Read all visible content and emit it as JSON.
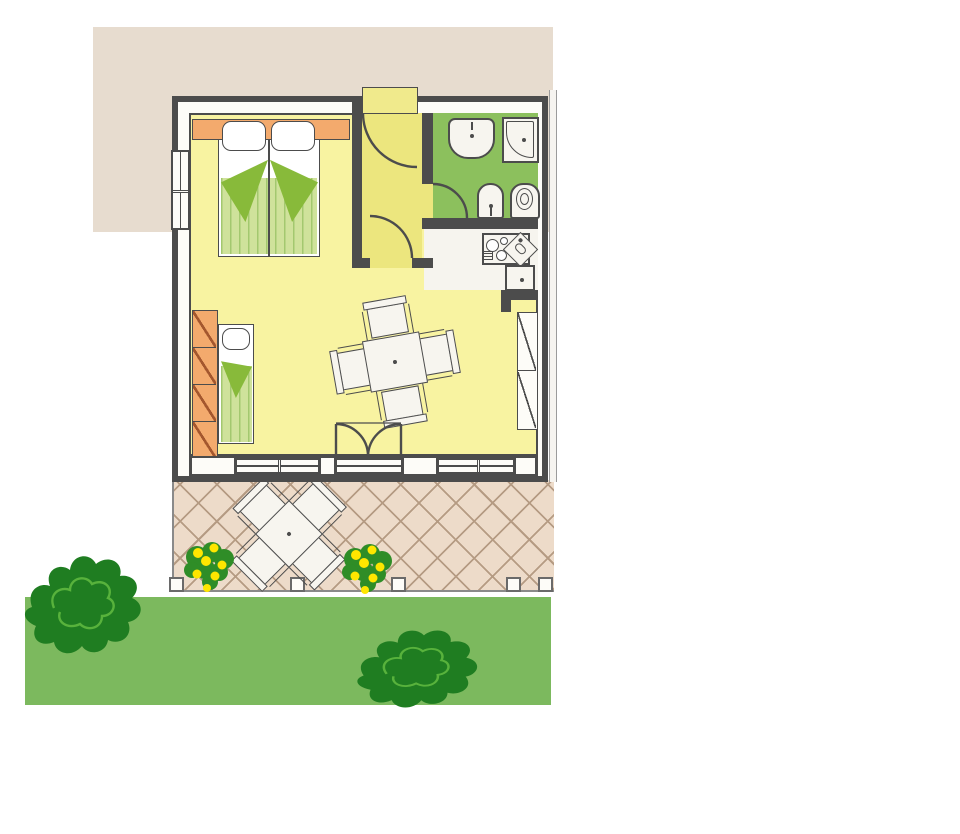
{
  "scene": {
    "kind": "holiday-bungalow floor plan illustration",
    "text_visible": "none",
    "rooms": [
      {
        "name": "sleeping-area",
        "floor_color_key": "floor",
        "furniture": [
          "double-bed with 2 pillows and green striped blanket",
          "orange headboard shelf",
          "single-bed with pillow and green striped blanket",
          "orange wardrobe with 4 compartments"
        ]
      },
      {
        "name": "living-area",
        "floor_color_key": "floor",
        "furniture": [
          "square dining table",
          "4 dining chairs",
          "built-in closet with 2 compartments"
        ]
      },
      {
        "name": "hallway",
        "floor_color_key": "hallway",
        "doors": [
          "entrance-door",
          "door-to-living-area",
          "door-to-bathroom"
        ]
      },
      {
        "name": "bathroom",
        "floor_color_key": "bath",
        "fixtures": [
          "washbasin",
          "shower",
          "bidet",
          "toilet"
        ]
      },
      {
        "name": "kitchenette",
        "floor_color_key": "kitchen",
        "fixtures": [
          "stove with 4 burners",
          "corner sink unit",
          "base cabinet"
        ]
      }
    ],
    "windows": {
      "left_wall": 1,
      "garden_wall": 2
    },
    "doors_total": 4,
    "outdoor": {
      "patio": {
        "paving": "diamond cross-hatch",
        "furniture": [
          "square patio table",
          "4 patio chairs"
        ],
        "posts": 5,
        "flowering_plants": 2
      },
      "garden": {
        "lawn_strip": 1,
        "bushes": 2
      },
      "backdrop_panel": "beige rectangle top-left"
    }
  },
  "colors": {
    "page_bg": "#ffffff",
    "backdrop": "#e7dccf",
    "wall": "#4c4c4c",
    "floor": "#f8f3a1",
    "hallway": "#ece67e",
    "entrance": "#f0ea8c",
    "bath": "#8cc05d",
    "kitchen": "#f6f4ee",
    "fixture": "#f7f5ef",
    "bed_light": "#cfe29b",
    "bed_stripe": "#a3c86f",
    "bed_fold": "#88ba3a",
    "orange": "#f3aa6d",
    "orange_diag": "#a4572e",
    "patio": "#eddbc9",
    "patio_line": "#b59b83",
    "lawn": "#7cb95e",
    "bush": "#1f7d21",
    "bush_inner": "#58b23c",
    "flower_leaf": "#2f8d27",
    "flower": "#ffe600",
    "gray_line": "#8a8a8a"
  }
}
